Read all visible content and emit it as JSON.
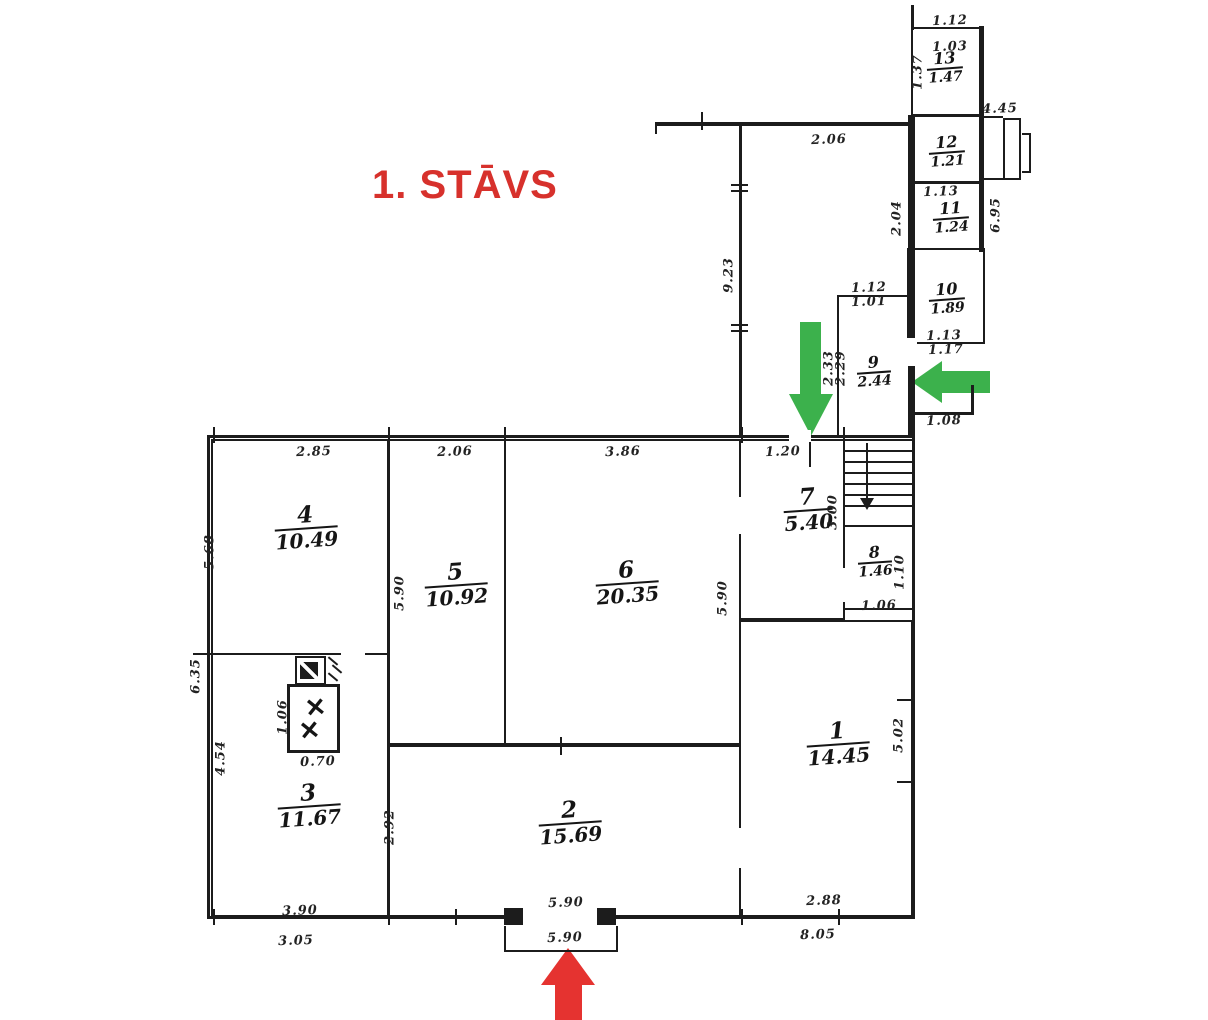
{
  "title": {
    "text": "1. STĀVS",
    "color": "#d7312c"
  },
  "colors": {
    "line": "#1c1c1c",
    "green_arrow": "#3cb14c",
    "red_arrow": "#e53330"
  },
  "rooms": [
    {
      "number": "1",
      "area": "14.45",
      "x": 838,
      "y": 744,
      "size": "lg"
    },
    {
      "number": "2",
      "area": "15.69",
      "x": 570,
      "y": 823,
      "size": "lg"
    },
    {
      "number": "3",
      "area": "11.67",
      "x": 309,
      "y": 806,
      "size": "lg"
    },
    {
      "number": "4",
      "area": "10.49",
      "x": 306,
      "y": 528,
      "size": "lg"
    },
    {
      "number": "5",
      "area": "10.92",
      "x": 456,
      "y": 585,
      "size": "lg"
    },
    {
      "number": "6",
      "area": "20.35",
      "x": 627,
      "y": 583,
      "size": "lg"
    },
    {
      "number": "7",
      "area": "5.40",
      "x": 808,
      "y": 510,
      "size": "lg"
    },
    {
      "number": "8",
      "area": "1.46",
      "x": 875,
      "y": 562,
      "size": "sm"
    },
    {
      "number": "9",
      "area": "2.44",
      "x": 874,
      "y": 372,
      "size": "sm"
    },
    {
      "number": "10",
      "area": "1.89",
      "x": 947,
      "y": 299,
      "size": "sm"
    },
    {
      "number": "11",
      "area": "1.24",
      "x": 951,
      "y": 218,
      "size": "sm"
    },
    {
      "number": "12",
      "area": "1.21",
      "x": 947,
      "y": 152,
      "size": "sm"
    },
    {
      "number": "13",
      "area": "1.47",
      "x": 945,
      "y": 68,
      "size": "sm"
    }
  ],
  "dims": [
    {
      "text": "1.12",
      "x": 950,
      "y": 21,
      "rot": false
    },
    {
      "text": "1.03",
      "x": 950,
      "y": 47,
      "rot": false
    },
    {
      "text": "1.37",
      "x": 918,
      "y": 72,
      "rot": true
    },
    {
      "text": "4.45",
      "x": 1000,
      "y": 109,
      "rot": false
    },
    {
      "text": "2.06",
      "x": 829,
      "y": 140,
      "rot": false
    },
    {
      "text": "2.04",
      "x": 897,
      "y": 218,
      "rot": true
    },
    {
      "text": "6.95",
      "x": 996,
      "y": 215,
      "rot": true
    },
    {
      "text": "1.13",
      "x": 941,
      "y": 192,
      "rot": false
    },
    {
      "text": "9.23",
      "x": 729,
      "y": 275,
      "rot": true
    },
    {
      "text": "1.13",
      "x": 944,
      "y": 336,
      "rot": false
    },
    {
      "text": "1.17",
      "x": 946,
      "y": 350,
      "rot": false
    },
    {
      "text": "1.12",
      "x": 869,
      "y": 288,
      "rot": false
    },
    {
      "text": "1.01",
      "x": 869,
      "y": 302,
      "rot": false
    },
    {
      "text": "2.33",
      "x": 829,
      "y": 368,
      "rot": true
    },
    {
      "text": "2.29",
      "x": 841,
      "y": 368,
      "rot": true
    },
    {
      "text": "1.08",
      "x": 944,
      "y": 421,
      "rot": false
    },
    {
      "text": "2.85",
      "x": 314,
      "y": 452,
      "rot": false
    },
    {
      "text": "2.06",
      "x": 455,
      "y": 452,
      "rot": false
    },
    {
      "text": "3.86",
      "x": 623,
      "y": 452,
      "rot": false
    },
    {
      "text": "1.20",
      "x": 783,
      "y": 452,
      "rot": false
    },
    {
      "text": "5.68",
      "x": 210,
      "y": 552,
      "rot": true
    },
    {
      "text": "6.35",
      "x": 196,
      "y": 676,
      "rot": true
    },
    {
      "text": "4.54",
      "x": 221,
      "y": 758,
      "rot": true
    },
    {
      "text": "5.90",
      "x": 400,
      "y": 593,
      "rot": true
    },
    {
      "text": "5.90",
      "x": 723,
      "y": 598,
      "rot": true
    },
    {
      "text": "3.00",
      "x": 833,
      "y": 512,
      "rot": true
    },
    {
      "text": "1.06",
      "x": 283,
      "y": 717,
      "rot": true
    },
    {
      "text": "0.70",
      "x": 318,
      "y": 762,
      "rot": false
    },
    {
      "text": "2.92",
      "x": 390,
      "y": 827,
      "rot": true
    },
    {
      "text": "1.10",
      "x": 900,
      "y": 572,
      "rot": true
    },
    {
      "text": "1.06",
      "x": 879,
      "y": 606,
      "rot": false
    },
    {
      "text": "5.02",
      "x": 899,
      "y": 735,
      "rot": true
    },
    {
      "text": "5.90",
      "x": 566,
      "y": 903,
      "rot": false
    },
    {
      "text": "5.90",
      "x": 565,
      "y": 938,
      "rot": false
    },
    {
      "text": "3.90",
      "x": 300,
      "y": 911,
      "rot": false
    },
    {
      "text": "3.05",
      "x": 296,
      "y": 941,
      "rot": false
    },
    {
      "text": "2.88",
      "x": 824,
      "y": 901,
      "rot": false
    },
    {
      "text": "8.05",
      "x": 818,
      "y": 935,
      "rot": false
    }
  ],
  "stove_marks": [
    "✕",
    "✕"
  ],
  "arrows": [
    {
      "id": "green-arrow-down",
      "direction": "down",
      "color_ref": "green_arrow"
    },
    {
      "id": "green-arrow-left",
      "direction": "left",
      "color_ref": "green_arrow"
    },
    {
      "id": "red-arrow-up",
      "direction": "up",
      "color_ref": "red_arrow"
    }
  ]
}
